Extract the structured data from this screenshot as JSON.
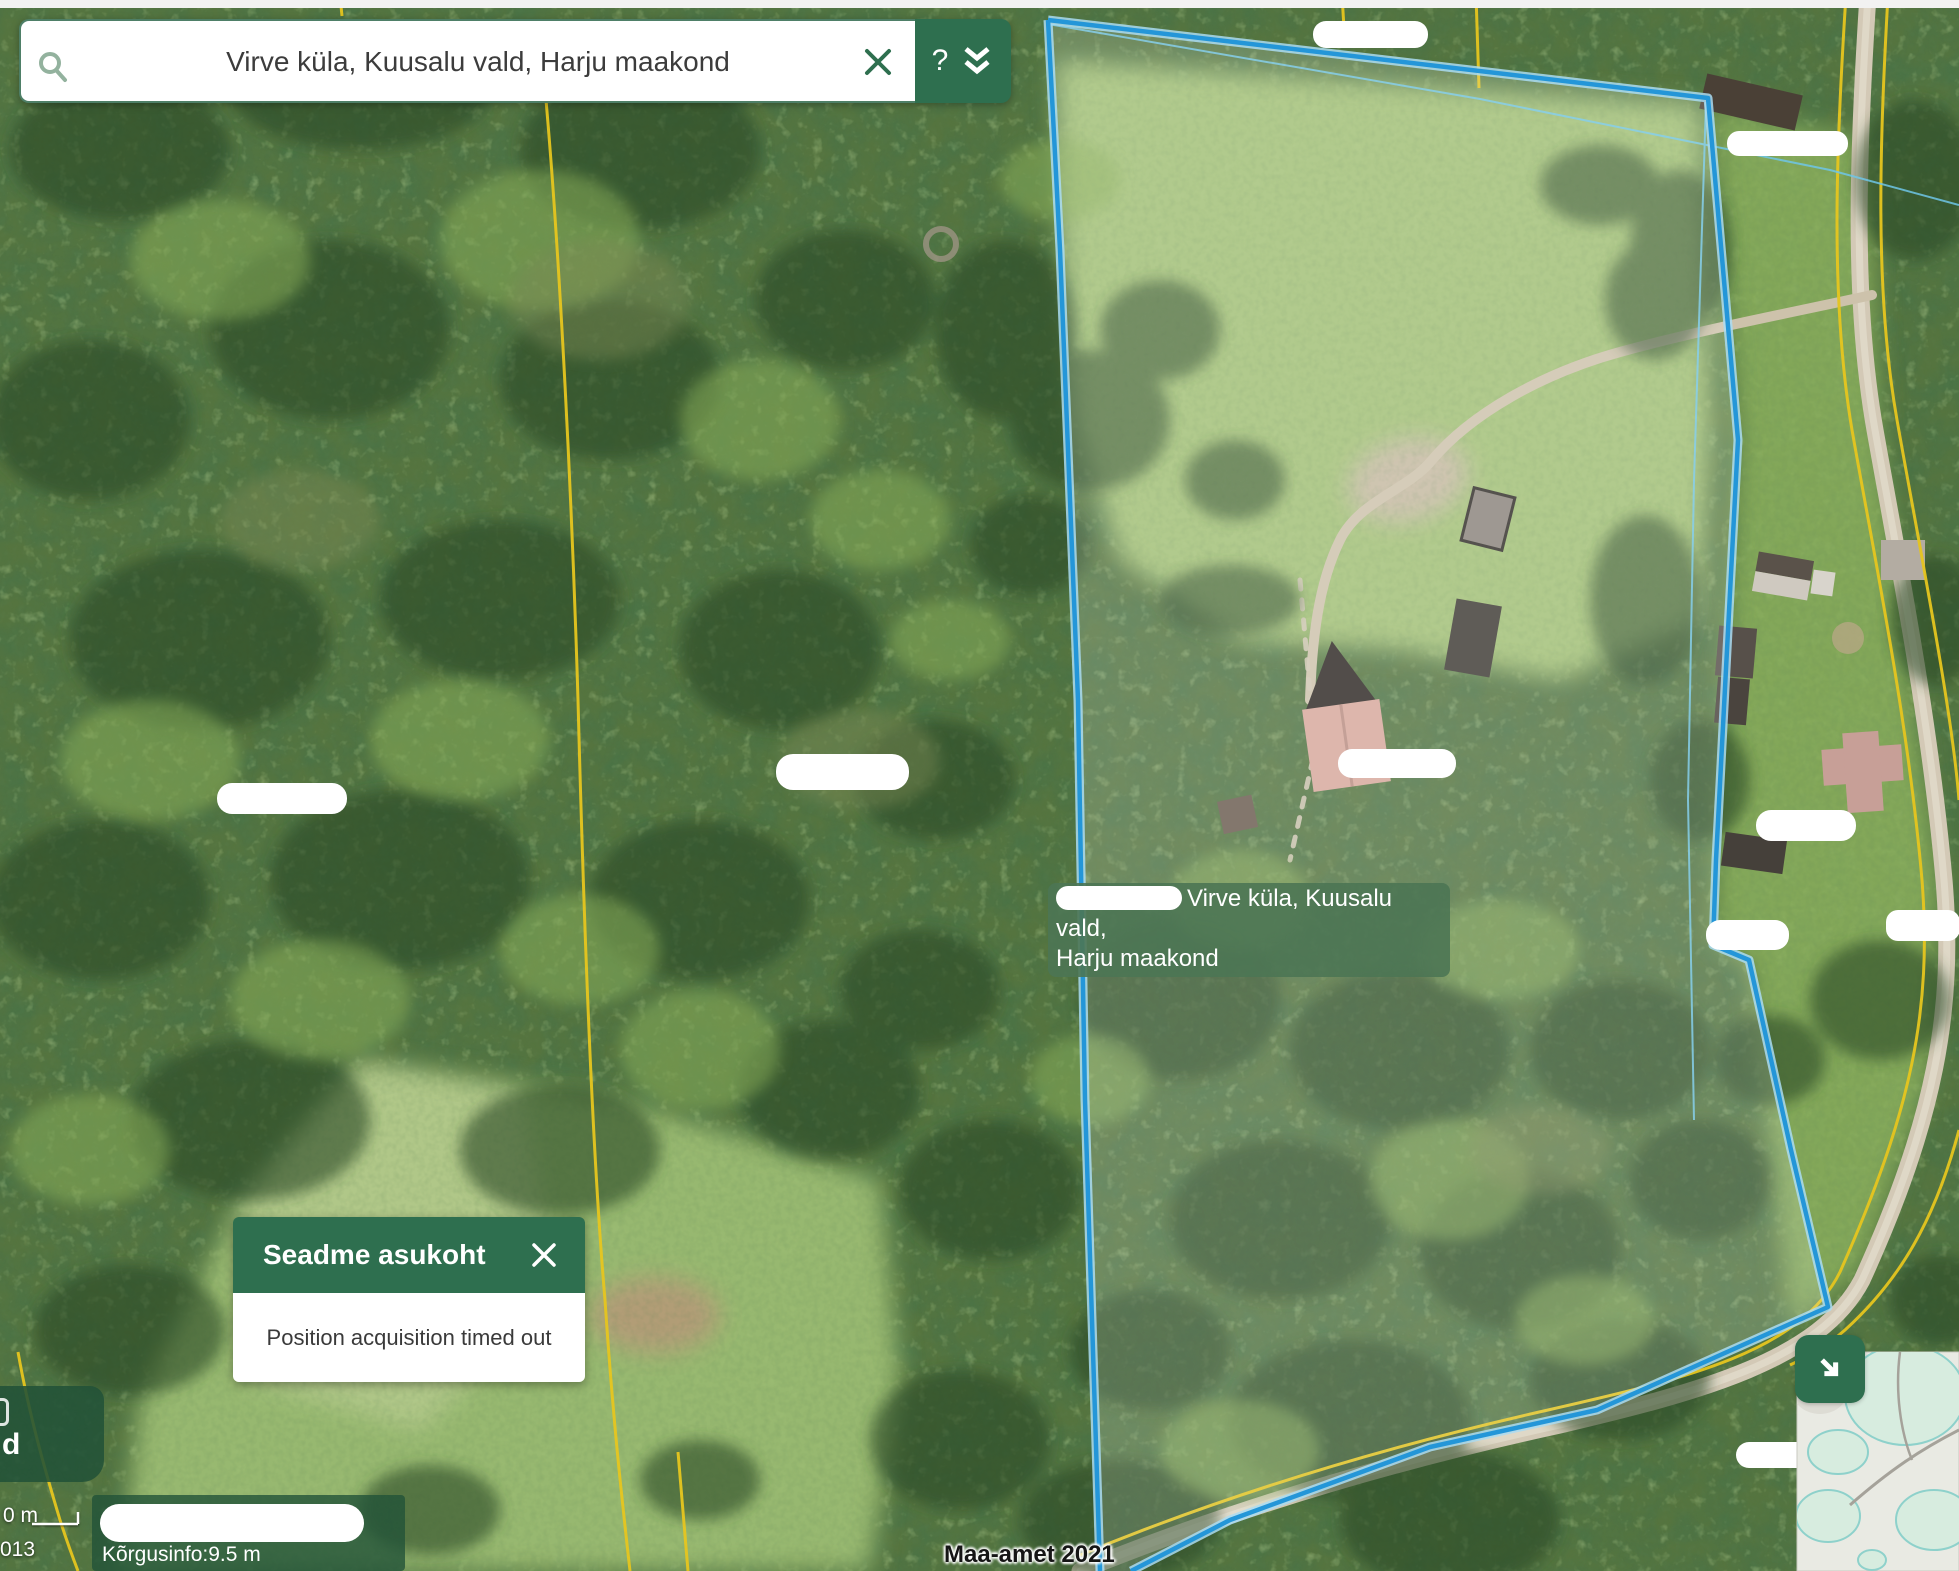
{
  "search_bar": {
    "query": "Virve küla, Kuusalu vald, Harju maakond",
    "help_label": "?"
  },
  "parcel_label": {
    "line1": "Virve küla, Kuusalu vald,",
    "line2": "Harju maakond"
  },
  "dialog": {
    "title": "Seadme asukoht",
    "message": "Position acquisition timed out"
  },
  "footer": {
    "scale_text": "0 m",
    "partial_code": "013",
    "elevation_text": "Kõrgusinfo:9.5 m",
    "attribution": "Maa-amet 2021"
  },
  "corner_label": {
    "road_number": "67",
    "partial_text": "d"
  },
  "icons": {
    "search": "magnifier-icon",
    "clear": "x-icon",
    "expand": "double-chevron-down-icon",
    "dialog_close": "x-icon",
    "minimap": "arrow-down-right-icon"
  },
  "colors": {
    "theme_green": "#2e6f4f",
    "panel_green": "rgba(34,82,56,0.85)",
    "label_green": "rgba(76,118,84,0.9)",
    "parcel_blue": "#2496d8",
    "parcel_blue_casing": "#aadcf2",
    "cadastral_yellow": "#e6c51f",
    "road_tan": "#d3c9b6"
  }
}
